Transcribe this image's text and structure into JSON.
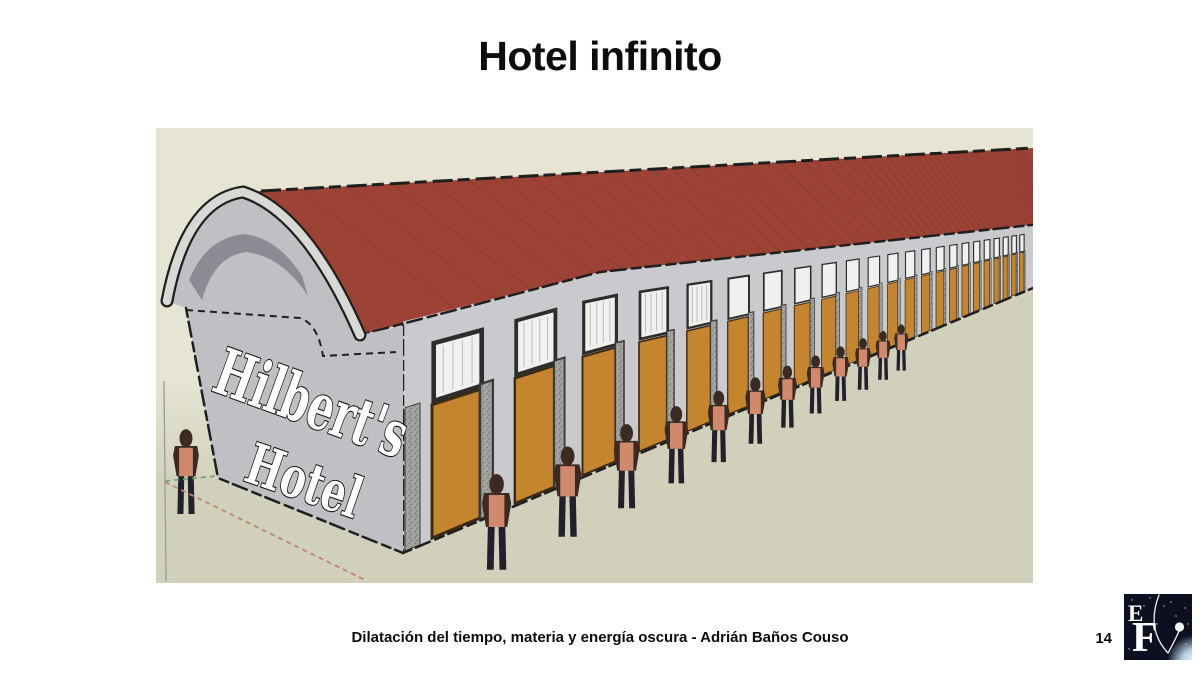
{
  "slide": {
    "title": "Hotel infinito",
    "footer": "Dilatación del tiempo, materia y energía oscura - Adrián Baños Couso",
    "page_number": "14"
  },
  "illustration": {
    "sign_line1": "Hilbert's",
    "sign_line2": "Hotel",
    "door_bays_visible": 23,
    "people_along_wall": 12,
    "people_front_left": 1,
    "colors": {
      "sky": "#e6e5d3",
      "ground": "#d0d0bb",
      "roof_red": "#9d4336",
      "roof_line": "#7c352c",
      "wall_gray": "#c9cacd",
      "front_face_gray": "#bfc0c4",
      "arch_band": "#d8d8d4",
      "arch_shadow": "#8b8b93",
      "door_orange": "#c5852e",
      "stone_frame": "#a3a3a0",
      "window_white": "#f1f0ee",
      "edge_dark": "#1f1f1f",
      "sign_fill": "#ffffff",
      "person_top": "#d0896a",
      "person_dark": "#3a2a22",
      "person_legs": "#23202b",
      "axis_red": "#c08378",
      "axis_green": "#6f9e6f",
      "axis_blue": "#9aa0a8"
    }
  },
  "logo": {
    "letter_top": "E",
    "letter_bottom": "F",
    "bg": "#0d1020",
    "star_white": "#f2f5f8",
    "planet_blue": "#b5cee3"
  }
}
